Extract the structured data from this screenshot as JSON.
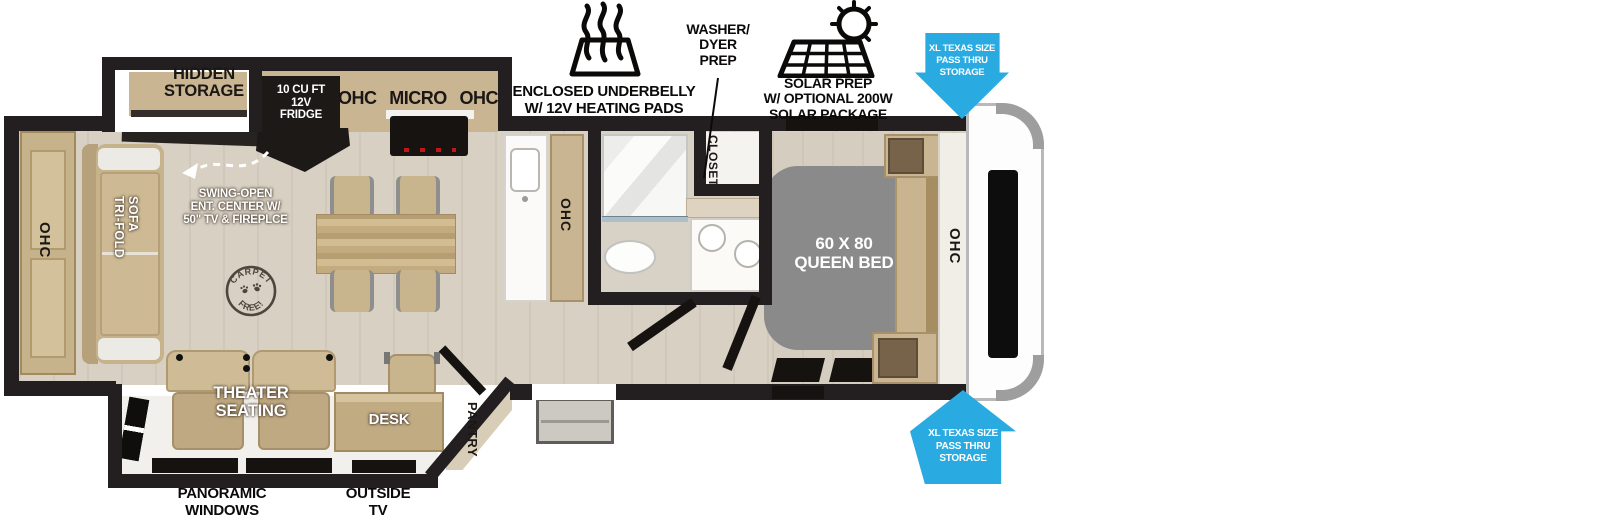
{
  "colors": {
    "wall": "#231f20",
    "accent_blue": "#29abe2",
    "floor": "#d7d0c3",
    "cabinet_tan": "#c9b592",
    "bed_gray": "#8a8a8a"
  },
  "callouts": {
    "underbelly": {
      "line1": "ENCLOSED UNDERBELLY",
      "line2": "W/ 12V HEATING PADS"
    },
    "washer_dryer": {
      "line1": "WASHER/",
      "line2": "DYER",
      "line3": "PREP"
    },
    "solar": {
      "line1": "SOLAR PREP",
      "line2": "W/ OPTIONAL 200W",
      "line3": "SOLAR PACKAGE"
    },
    "storage_top": {
      "line1": "XL TEXAS SIZE",
      "line2": "PASS THRU",
      "line3": "STORAGE"
    },
    "storage_bottom": {
      "line1": "XL TEXAS SIZE",
      "line2": "PASS THRU",
      "line3": "STORAGE"
    },
    "panoramic_windows": {
      "line1": "PANORAMIC",
      "line2": "WINDOWS"
    },
    "outside_tv": {
      "line1": "OUTSIDE",
      "line2": "TV"
    }
  },
  "labels": {
    "hidden_storage": {
      "line1": "HIDDEN",
      "line2": "STORAGE"
    },
    "fridge": {
      "line1": "10 CU FT",
      "line2": "12V",
      "line3": "FRIDGE"
    },
    "kitchen_ohc_left": "OHC",
    "micro": "MICRO",
    "kitchen_ohc_right": "OHC",
    "counter_ohc": "OHC",
    "rear_ohc": "OHC",
    "bedroom_ohc": "OHC",
    "sofa": {
      "line1": "TRI-FOLD",
      "line2": "SOFA"
    },
    "swing_open": {
      "line1": "SWING-OPEN",
      "line2": "ENT. CENTER W/",
      "line3": "50\" TV & FIREPLCE"
    },
    "carpet_free": {
      "top": "CARPET",
      "bottom": "FREE!"
    },
    "closet": "CLOSET",
    "queen_bed": {
      "line1": "60 X 80",
      "line2": "QUEEN BED"
    },
    "theater": {
      "line1": "THEATER",
      "line2": "SEATING"
    },
    "desk": "DESK",
    "pantry": "PANTRY"
  }
}
